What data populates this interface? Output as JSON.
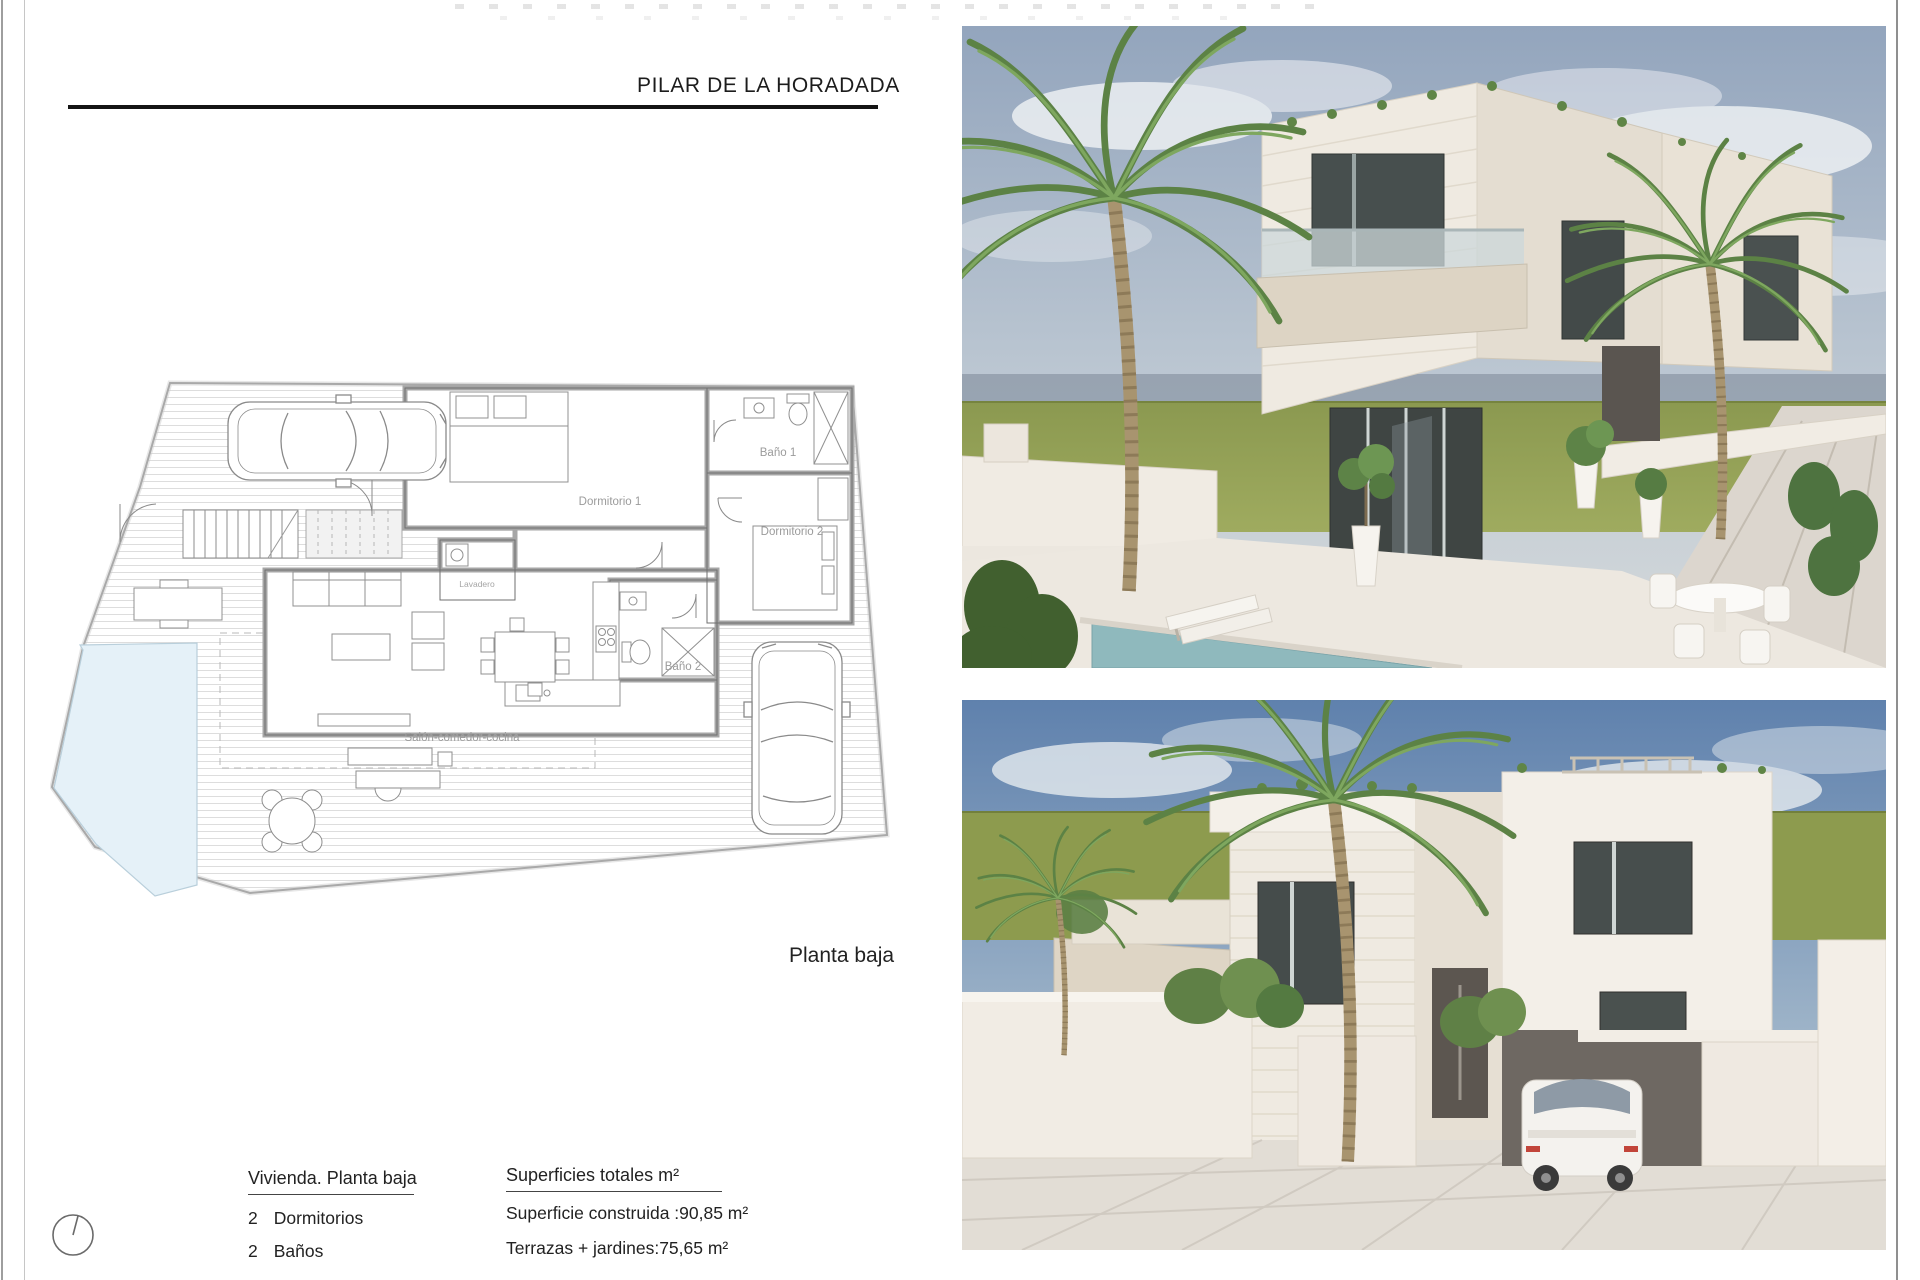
{
  "page": {
    "title": "PILAR DE LA HORADADA",
    "palette": {
      "paper": "#ffffff",
      "rule": "#141414",
      "plan_wall": "#a6a6a6",
      "plan_line": "#8f8f8f",
      "deck_stripe": "#dddddd",
      "pool_fill": "#e5f1f8",
      "sky_top_render1": "#93a5bd",
      "sky_top_render2": "#5f81ad",
      "lawn": "#93a055",
      "house_wall": "#efeae2",
      "window_glass": "#3f4543",
      "pool_water_render": "#8fb9bd"
    }
  },
  "floor_plan": {
    "caption": "Planta baja",
    "rooms": {
      "dormitorio1": "Dormitorio 1",
      "bano1": "Baño 1",
      "dormitorio2": "Dormitorio 2",
      "lavadero": "Lavadero",
      "bano2": "Baño 2",
      "salon": "Salón-comedor-cocina"
    }
  },
  "summary": {
    "title": "Vivienda. Planta baja",
    "rows": [
      {
        "count": "2",
        "label": "Dormitorios"
      },
      {
        "count": "2",
        "label": "Baños"
      }
    ]
  },
  "areas": {
    "title": "Superficies totales m²",
    "rows": [
      {
        "label": "Superficie construida :",
        "value": "90,85 m²"
      },
      {
        "label": "Terrazas + jardines:",
        "value": "75,65 m²"
      }
    ]
  },
  "icons": {
    "north_indicator": "circle-with-needle"
  }
}
